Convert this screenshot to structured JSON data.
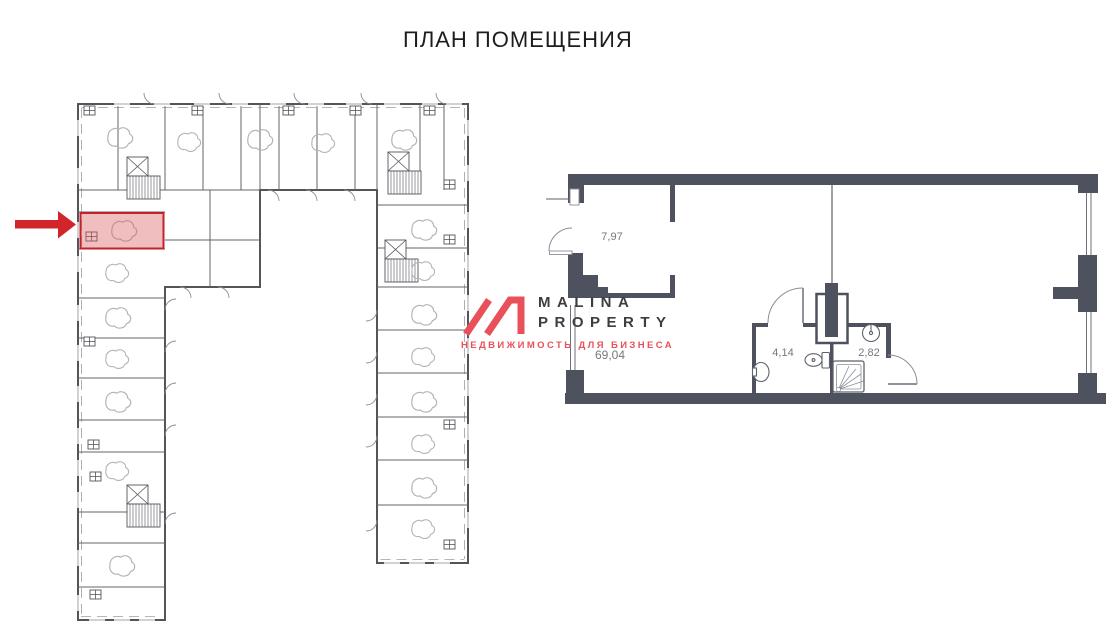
{
  "page": {
    "title": "ПЛАН ПОМЕЩЕНИЯ"
  },
  "overview_plan": {
    "description": "U-shaped building floor overview",
    "wall_color": "#54555b",
    "highlighted_unit": {
      "fill": "#d9535a",
      "border": "#c2232a"
    },
    "arrow_color": "#d2252b"
  },
  "detail_plan": {
    "description": "Detailed plan of highlighted unit",
    "wall_color": "#4d525e",
    "labels": {
      "hall": "7,97",
      "main": "69,04",
      "wc": "4,14",
      "shower": "2,82"
    }
  },
  "watermark": {
    "brand_line1": "MALINA",
    "brand_line2": "PROPERTY",
    "tagline": "НЕДВИЖИМОСТЬ ДЛЯ БИЗНЕСА",
    "accent_color": "#e8515a",
    "text_color": "#3e3e40"
  }
}
